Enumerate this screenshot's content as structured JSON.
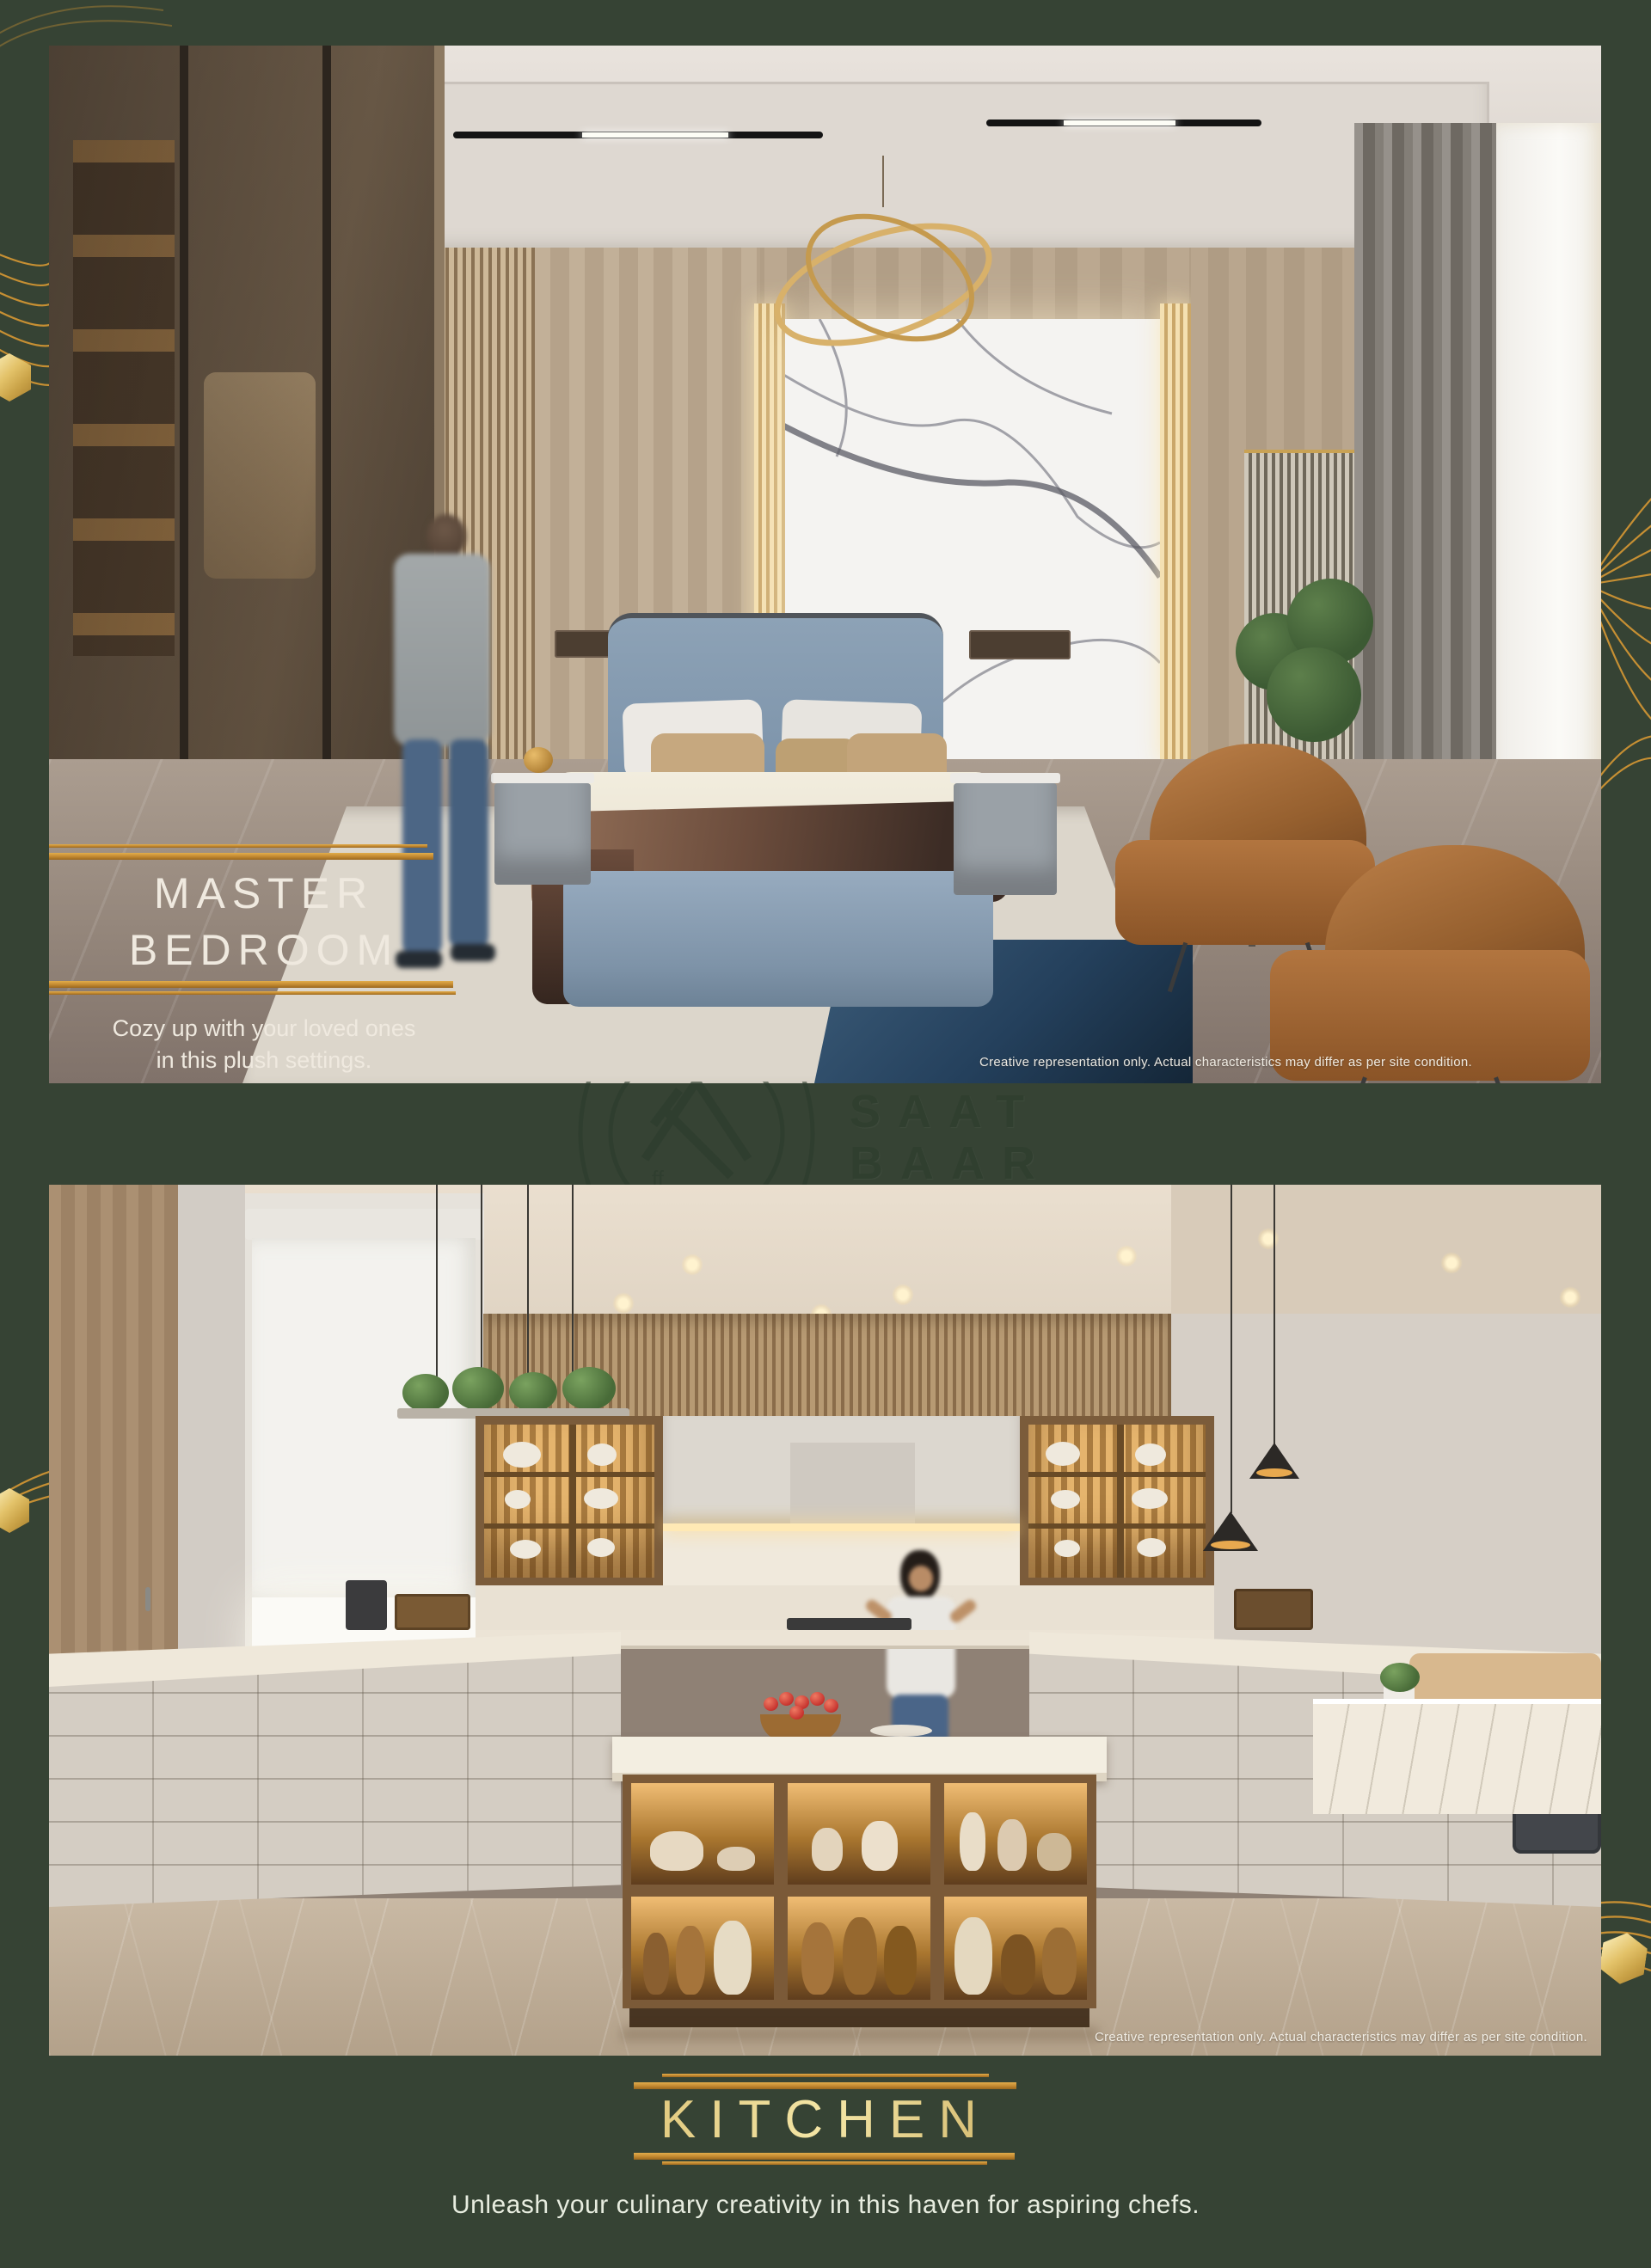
{
  "page": {
    "background_color": "#364334",
    "accent_gold": "#c68f33",
    "watermark": {
      "line1": "SAAT",
      "line2": "BAAR",
      "logo": "saat-baar-monogram"
    }
  },
  "bedroom": {
    "title_line1": "MASTER",
    "title_line2": "BEDROOM",
    "caption_line1": "Cozy up with your loved ones",
    "caption_line2": "in this plush settings.",
    "disclaimer": "Creative representation only. Actual characteristics may differ as per site condition."
  },
  "kitchen": {
    "title": "KITCHEN",
    "caption": "Unleash your culinary creativity in this haven for aspiring chefs.",
    "disclaimer": "Creative representation only. Actual characteristics may differ as per site condition."
  }
}
